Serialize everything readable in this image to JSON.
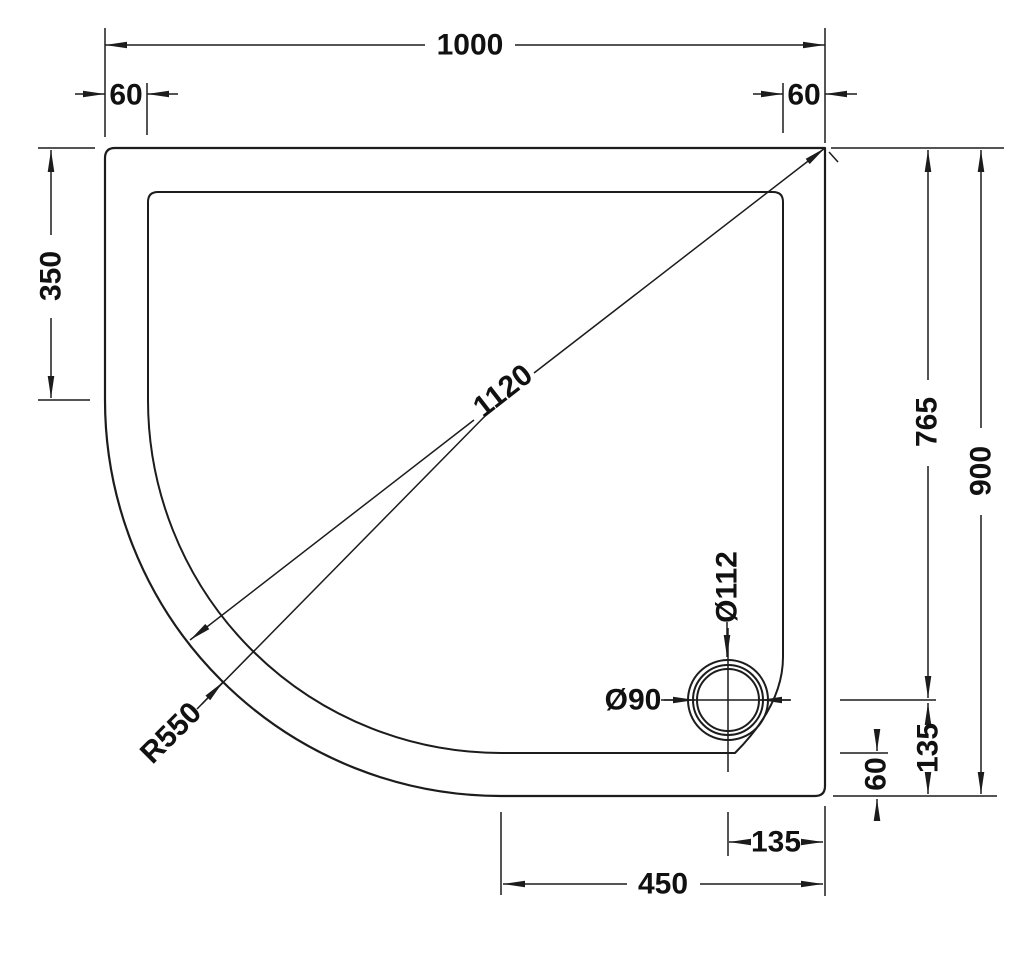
{
  "drawing": {
    "type": "technical-dimension-drawing",
    "subject": "offset-quadrant-tray-plan-view",
    "colors": {
      "line": "#1c1c1c",
      "text": "#111111",
      "background": "#ffffff"
    },
    "dimensions": {
      "top_width": "1000",
      "top_left_rim": "60",
      "top_right_rim": "60",
      "left_straight_height": "350",
      "right_waste_offset_height": "765",
      "right_total_height": "900",
      "diagonal": "1120",
      "corner_radius": "R550",
      "waste_outer_diameter": "Ø112",
      "waste_inner_diameter": "Ø90",
      "waste_to_right_edge": "135",
      "bottom_rim": "60",
      "waste_to_bottom_edge": "135",
      "bottom_straight_width": "450"
    }
  }
}
